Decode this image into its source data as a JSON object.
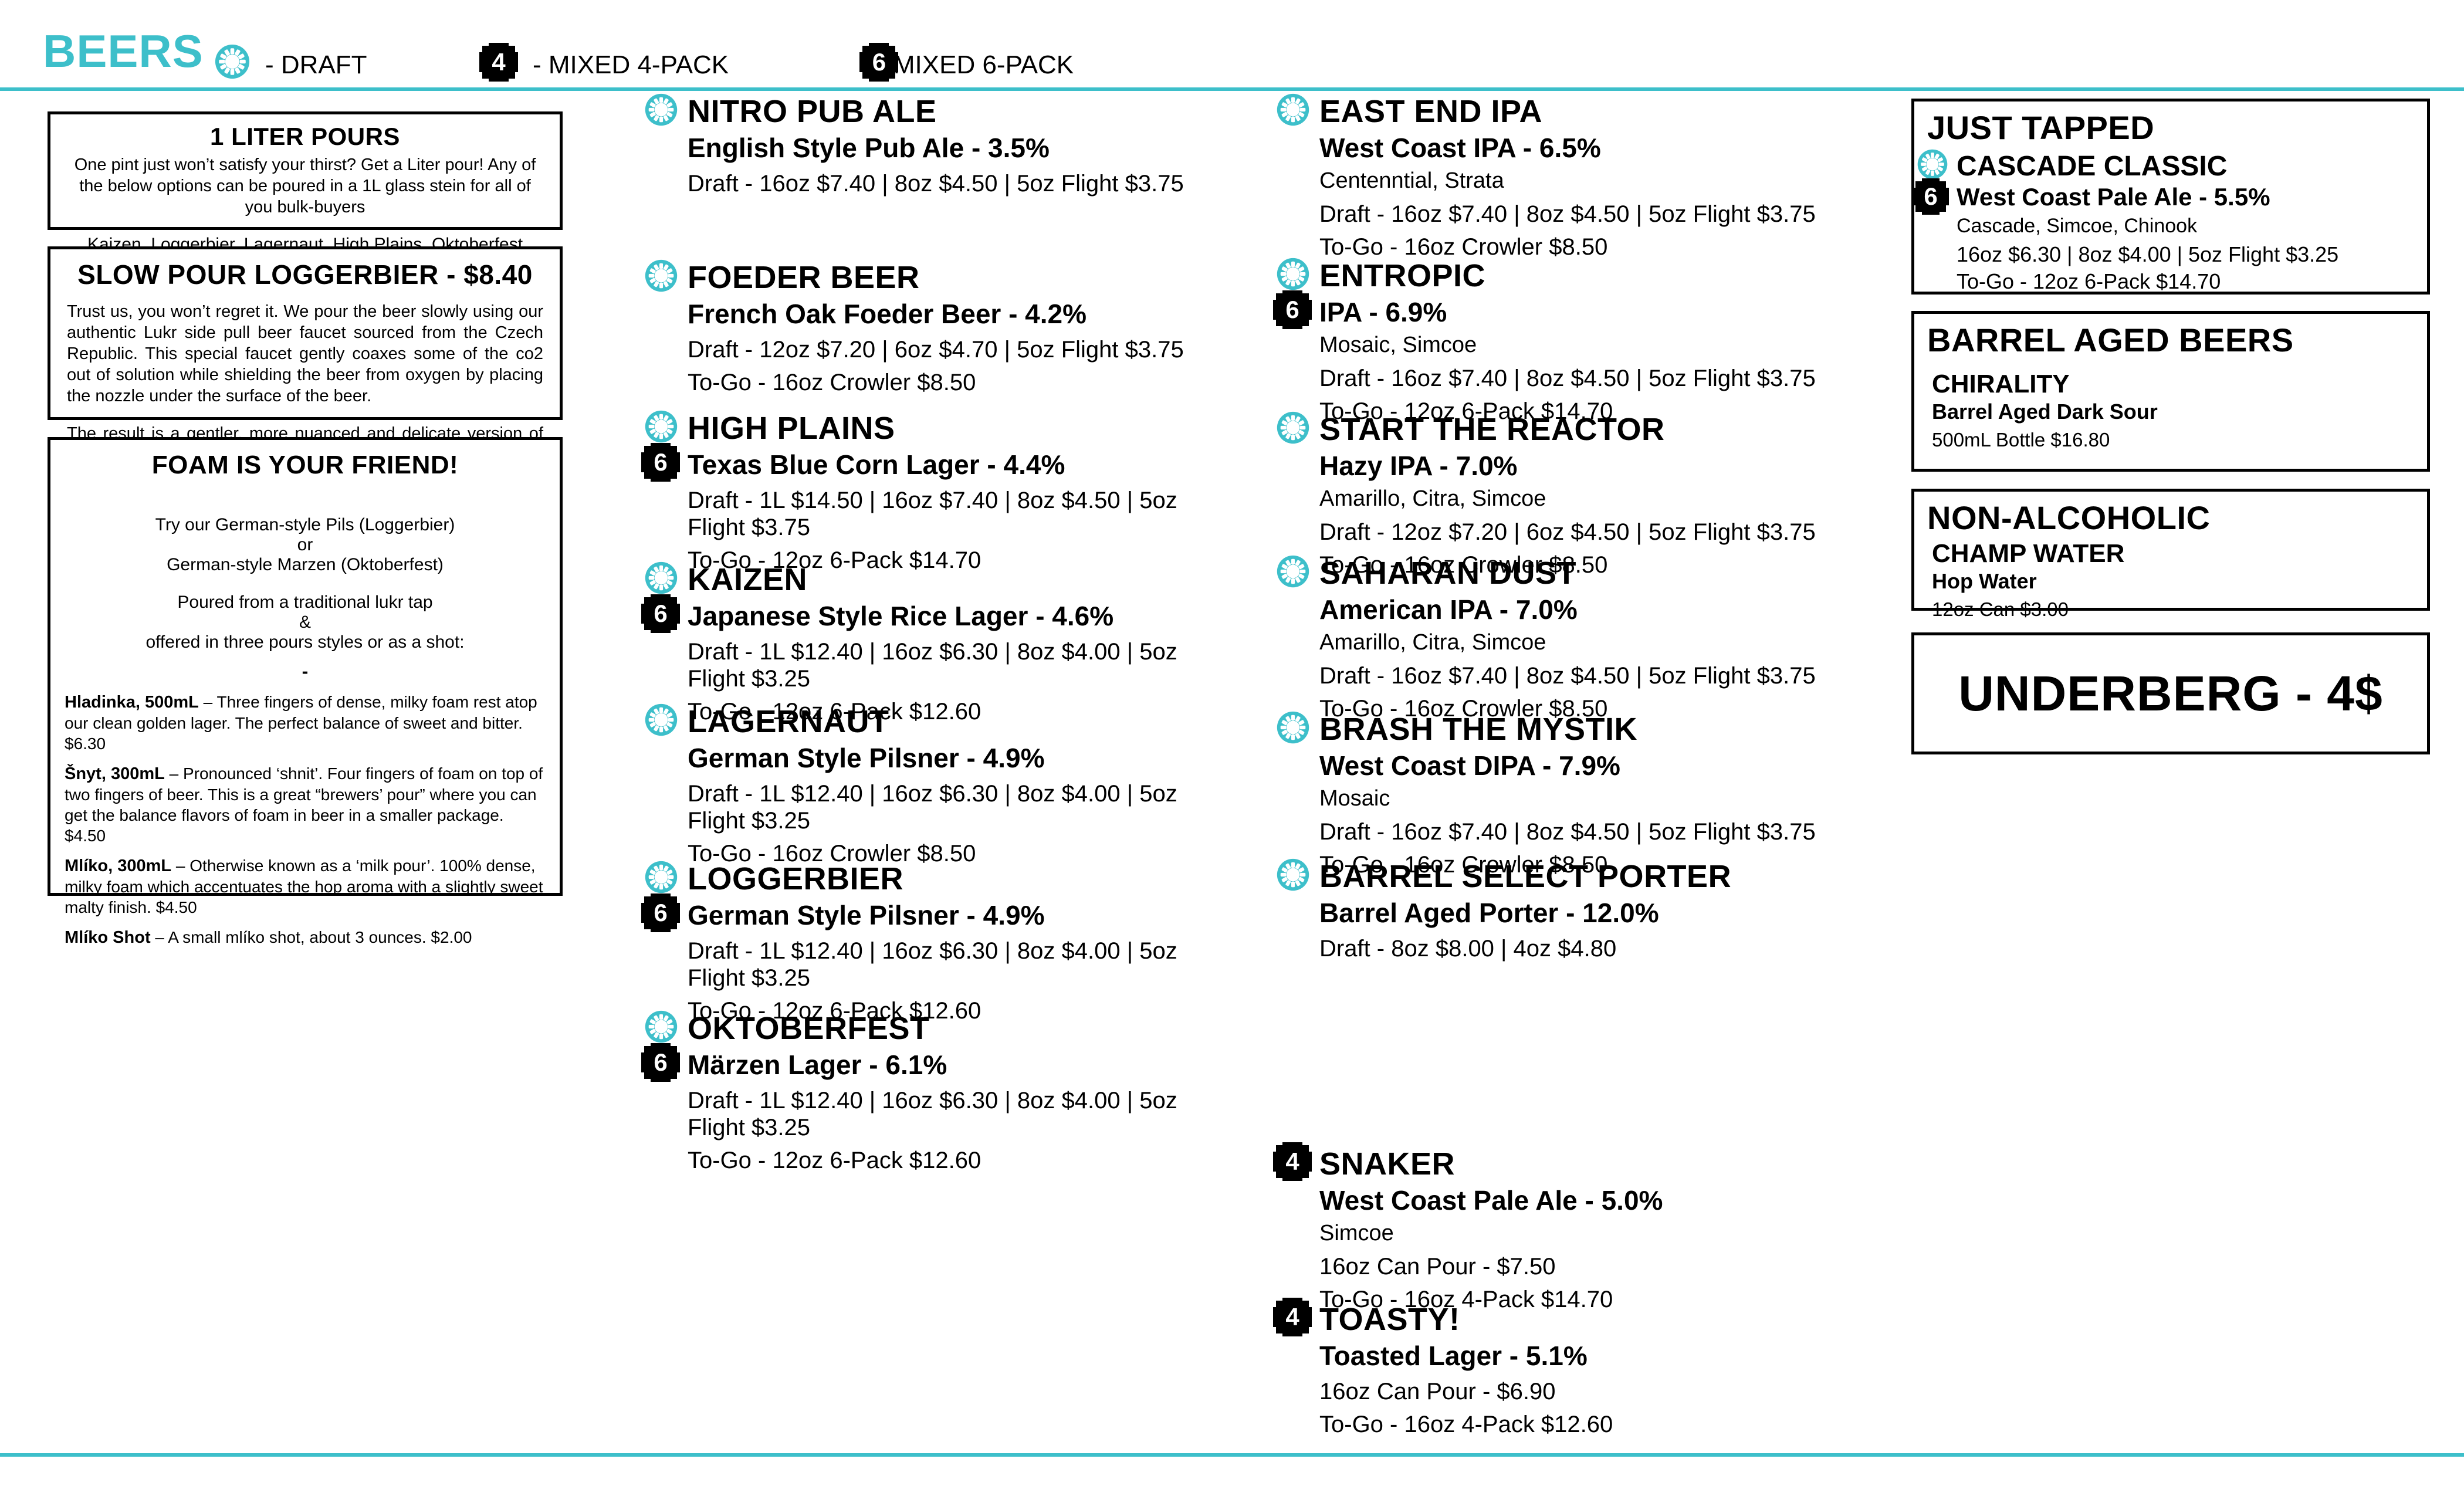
{
  "page": {
    "accent_color": "#3dbfca",
    "ink_color": "#000000",
    "background": "#ffffff"
  },
  "header": {
    "title": "BEERS",
    "legend_draft": "- DRAFT",
    "legend_four": "- MIXED 4-PACK",
    "legend_six": "- MIXED 6-PACK"
  },
  "icons": {
    "four": "4",
    "six": "6"
  },
  "boxes": {
    "liter": {
      "title": "1 LITER POURS",
      "body": "One pint just won’t satisfy your thirst? Get a Liter pour! Any of the below options can be poured in a 1L glass stein for all of you bulk-buyers",
      "list": "Kaizen, Loggerbier, Lagernaut, High Plains, Oktoberfest"
    },
    "slow_pour": {
      "title": "SLOW POUR LOGGERBIER - $8.40",
      "p1": "Trust us, you won’t regret it. We pour the beer slowly using our authentic Lukr side pull beer faucet sourced from the Czech Republic. This special faucet gently coaxes some of the co2 out of solution while shielding the beer from oxygen by placing the nozzle under the surface of the beer.",
      "p2": "The result is a gentler, more nuanced and delicate version of the beer that sits under a tall, almost merengue-like head. It is absolutely worth the wait."
    },
    "foam": {
      "title": "FOAM IS YOUR FRIEND!",
      "line1": "Try our German-style Pils (Loggerbier)",
      "line2": "or",
      "line3": "German-style Marzen (Oktoberfest)",
      "line4": "Poured from a traditional lukr tap",
      "line5": "&",
      "line6": "offered in three pours styles or as a shot:",
      "dash": "-",
      "pours": [
        {
          "name": "Hladinka, 500mL",
          "desc": " – Three fingers of dense, milky foam rest atop our clean golden lager. The perfect balance of sweet and bitter. $6.30"
        },
        {
          "name": "Šnyt, 300mL",
          "desc": " – Pronounced ‘shnit’. Four fingers of foam on top of two fingers of beer. This is a great “brewers’ pour” where you can get the balance flavors of foam in beer in a smaller package. $4.50"
        },
        {
          "name": "Mlíko, 300mL",
          "desc": " – Otherwise known as a ‘milk pour’. 100% dense, milky foam which accentuates the hop aroma with a slightly sweet malty finish. $4.50"
        },
        {
          "name": "Mlíko Shot",
          "desc": " – A small mlíko shot, about 3 ounces. $2.00"
        }
      ]
    },
    "just_tapped": {
      "title": "JUST TAPPED"
    },
    "barrel_aged": {
      "title": "BARREL AGED BEERS"
    },
    "non_alcoholic": {
      "title": "NON-ALCOHOLIC"
    },
    "underberg": {
      "title": "UNDERBERG - 4$"
    }
  },
  "beers": {
    "nitro": {
      "name": "NITRO PUB ALE",
      "style": "English Style Pub Ale - 3.5%",
      "price": "Draft - 16oz $7.40 | 8oz $4.50 | 5oz Flight $3.75"
    },
    "foeder": {
      "name": "FOEDER BEER",
      "style": "French Oak Foeder Beer - 4.2%",
      "price": "Draft - 12oz $7.20  |  6oz $4.70  |  5oz Flight $3.75",
      "togo": "To-Go - 16oz Crowler $8.50"
    },
    "high_plains": {
      "name": "HIGH PLAINS",
      "style": "Texas Blue Corn Lager - 4.4%",
      "price": "Draft - 1L $14.50  | 16oz $7.40  |  8oz $4.50  |  5oz Flight $3.75",
      "togo": "To-Go - 12oz 6-Pack $14.70"
    },
    "kaizen": {
      "name": "KAIZEN",
      "style": "Japanese Style Rice Lager - 4.6%",
      "price": "Draft - 1L $12.40  | 16oz $6.30  |  8oz $4.00  |  5oz Flight $3.25",
      "togo": "To-Go - 12oz 6-Pack $12.60"
    },
    "lagernaut": {
      "name": "LAGERNAUT",
      "style": "German Style Pilsner - 4.9%",
      "price": "Draft - 1L $12.40  | 16oz $6.30  |  8oz $4.00  |  5oz Flight $3.25",
      "togo": "To-Go - 16oz Crowler $8.50"
    },
    "loggerbier": {
      "name": "LOGGERBIER",
      "style": "German Style Pilsner - 4.9%",
      "price": "Draft - 1L $12.40  | 16oz $6.30  |  8oz $4.00  |  5oz Flight $3.25",
      "togo": "To-Go - 12oz 6-Pack $12.60"
    },
    "oktoberfest": {
      "name": "OKTOBERFEST",
      "style": "Märzen Lager - 6.1%",
      "price": "Draft - 1L $12.40  | 16oz $6.30  |  8oz $4.00  |  5oz Flight $3.25",
      "togo": "To-Go - 12oz 6-Pack $12.60"
    },
    "east_end": {
      "name": "EAST END IPA",
      "style": "West Coast IPA - 6.5%",
      "hops": "Centenntial, Strata",
      "price": "Draft - 16oz $7.40 | 8oz $4.50 | 5oz Flight $3.75",
      "togo": "To-Go - 16oz Crowler $8.50"
    },
    "entropic": {
      "name": "ENTROPIC",
      "style": "IPA - 6.9%",
      "hops": "Mosaic, Simcoe",
      "price": "Draft - 16oz $7.40 | 8oz $4.50 | 5oz Flight $3.75",
      "togo": "To-Go - 12oz 6-Pack $14.70"
    },
    "reactor": {
      "name": "START THE REACTOR",
      "style": "Hazy IPA - 7.0%",
      "hops": "Amarillo, Citra, Simcoe",
      "price": "Draft - 12oz $7.20 | 6oz $4.50 | 5oz Flight $3.75",
      "togo": "To-Go - 16oz Crowler $8.50"
    },
    "saharan": {
      "name": "SAHARAN DUST",
      "style": "American IPA - 7.0%",
      "hops": "Amarillo, Citra, Simcoe",
      "price": "Draft - 16oz $7.40 | 8oz $4.50 | 5oz Flight $3.75",
      "togo": "To-Go - 16oz Crowler $8.50"
    },
    "brash": {
      "name": "BRASH THE MYSTIK",
      "style": "West Coast DIPA - 7.9%",
      "hops": "Mosaic",
      "price": "Draft - 16oz $7.40 | 8oz $4.50 | 5oz Flight $3.75",
      "togo": "To-Go - 16oz Crowler $8.50"
    },
    "barrel_select": {
      "name": "BARREL SELECT PORTER",
      "style": "Barrel Aged Porter - 12.0%",
      "price": "Draft - 8oz $8.00  |  4oz $4.80"
    },
    "snaker": {
      "name": "SNAKER",
      "style": "West Coast Pale Ale - 5.0%",
      "hops": "Simcoe",
      "price": "16oz Can Pour - $7.50",
      "togo": "To-Go - 16oz 4-Pack $14.70"
    },
    "toasty": {
      "name": "TOASTY!",
      "style": "Toasted Lager - 5.1%",
      "price": "16oz Can Pour - $6.90",
      "togo": "To-Go - 16oz 4-Pack $12.60"
    },
    "cascade": {
      "name": "CASCADE CLASSIC",
      "style": "West Coast Pale Ale - 5.5%",
      "hops": "Cascade, Simcoe, Chinook",
      "price": "16oz $6.30 | 8oz $4.00 | 5oz Flight $3.25",
      "togo": "To-Go - 12oz 6-Pack $14.70"
    },
    "chirality": {
      "name": "CHIRALITY",
      "style": "Barrel Aged Dark Sour",
      "price": "500mL Bottle $16.80"
    },
    "champ": {
      "name": "CHAMP WATER",
      "style": "Hop Water",
      "price": "12oz Can $3.00"
    }
  }
}
